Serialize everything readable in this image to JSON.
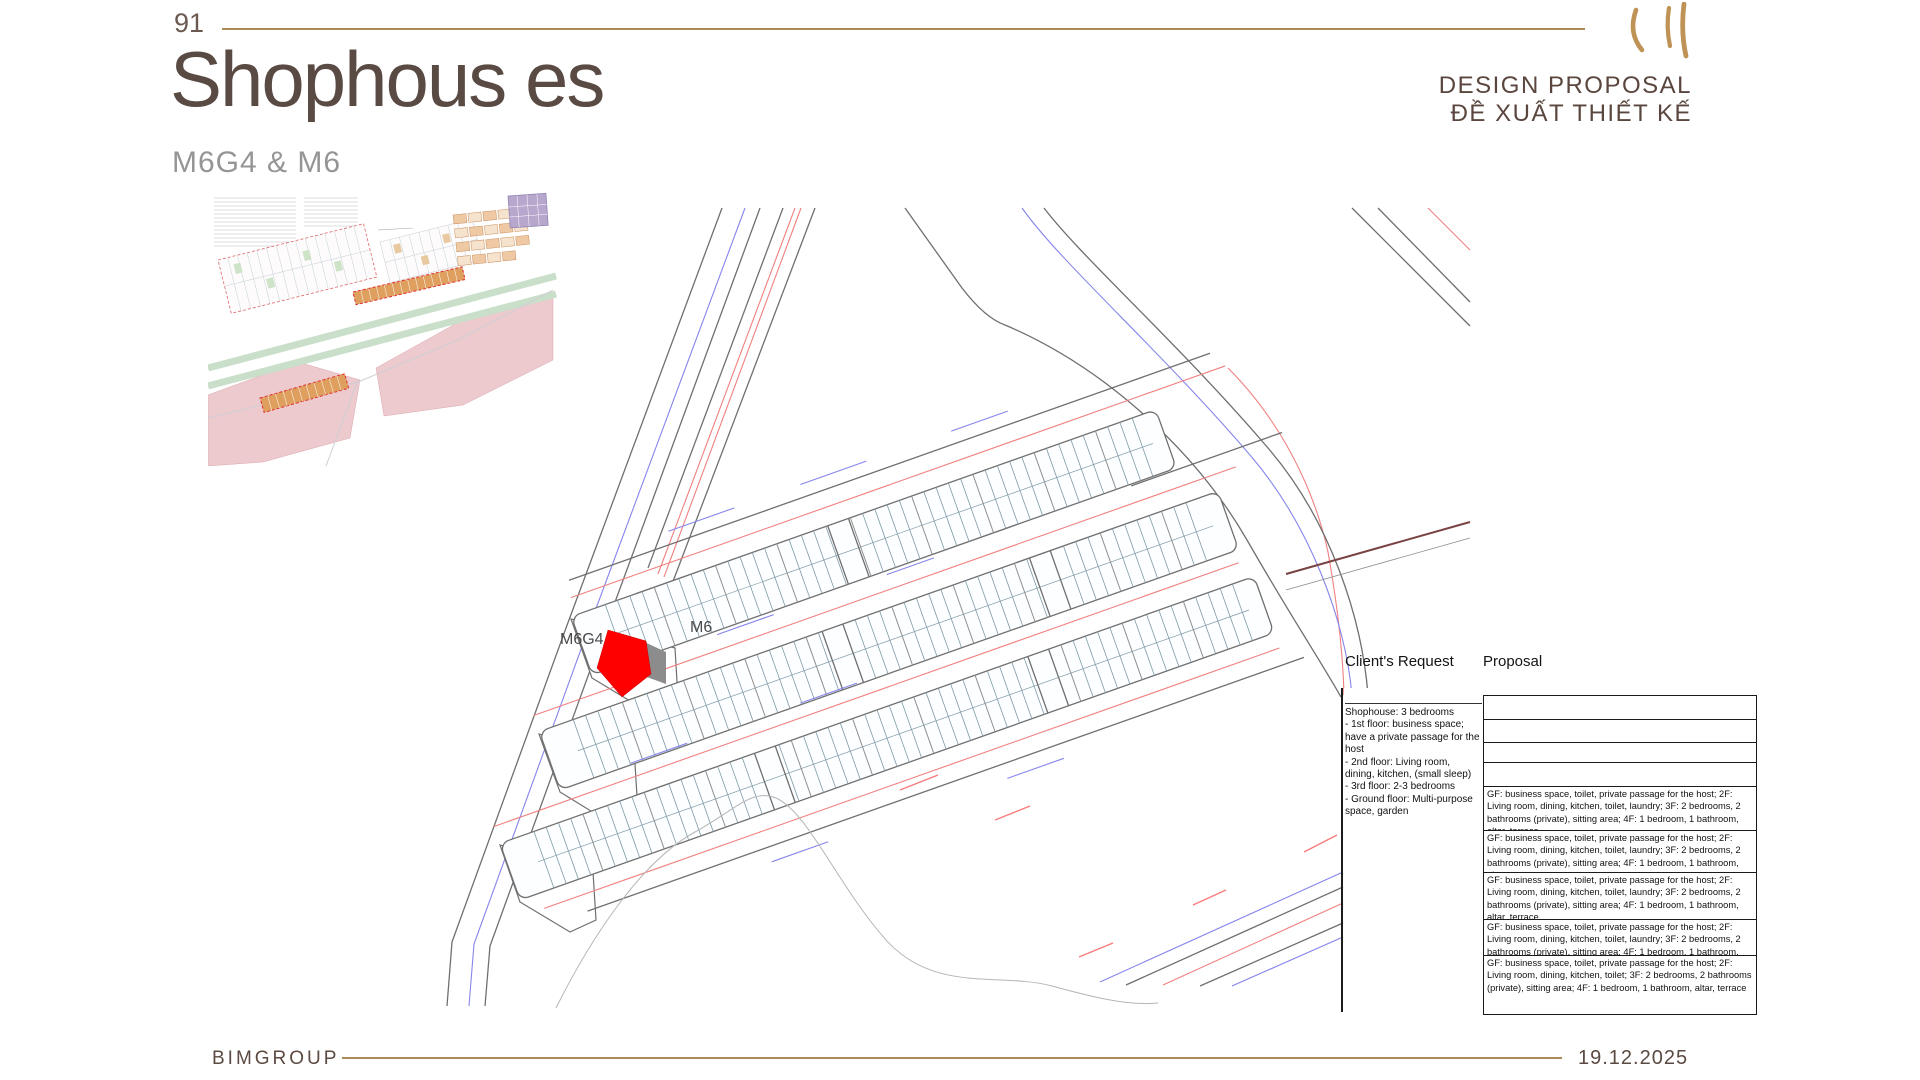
{
  "page": {
    "number": "91",
    "title": "Shophous es",
    "subtitle": "M6G4 & M6"
  },
  "header": {
    "proposal_line1": "DESIGN PROPOSAL",
    "proposal_line2": "ĐỀ XUẤT THIẾT KẾ"
  },
  "plan": {
    "labels": {
      "m6g4": "M6G4",
      "m6": "M6"
    },
    "highlight_color": "#ff0000",
    "neighbor_color": "#8c8c8c"
  },
  "panel": {
    "client_header": "Client's Request",
    "proposal_header": "Proposal",
    "client_request": "Shophouse: 3 bedrooms\n- 1st floor: business space; have a private passage for the host\n- 2nd floor: Living room, dining, kitchen, (small sleep)\n- 3rd floor: 2-3 bedrooms\n- Ground floor: Multi-purpose space, garden",
    "proposal_rows": [
      "",
      "",
      "",
      "",
      "GF: business space, toilet, private passage for the host; 2F: Living room, dining, kitchen, toilet, laundry; 3F: 2 bedrooms, 2 bathrooms (private), sitting area; 4F: 1 bedroom, 1 bathroom, altar, terrace",
      "GF: business space, toilet, private passage for the host; 2F: Living room, dining, kitchen, toilet, laundry; 3F: 2 bedrooms, 2 bathrooms (private), sitting area; 4F: 1 bedroom, 1 bathroom, altar, terrace",
      "GF: business space, toilet, private passage for the host; 2F: Living room, dining, kitchen, toilet, laundry; 3F: 2 bedrooms, 2 bathrooms (private), sitting area; 4F: 1 bedroom, 1 bathroom, altar, terrace",
      "GF: business space, toilet, private passage for the host; 2F: Living room, dining, kitchen, toilet, laundry; 3F: 2 bedrooms, 2 bathrooms (private), sitting area; 4F: 1 bedroom, 1 bathroom, altar, terrace",
      "GF: business space, toilet, private passage for the host; 2F: Living room, dining, kitchen, toilet; 3F: 2 bedrooms, 2 bathrooms (private), sitting area; 4F: 1 bedroom, 1 bathroom, altar, terrace"
    ]
  },
  "footer": {
    "company": "BIMGROUP",
    "date": "19.12.2025"
  },
  "colors": {
    "gold": "#ab8a57",
    "title_text": "#594a43",
    "subtitle_text": "#959595",
    "road_gray": "#6f6f6f",
    "road_red": "#f08080",
    "road_blue": "#8585ec",
    "lot_divider_teal": "#7e9aa8",
    "highlight_red": "#ff0000",
    "neighbor_gray": "#8c8c8c",
    "annotation_brown": "#7a4343"
  }
}
